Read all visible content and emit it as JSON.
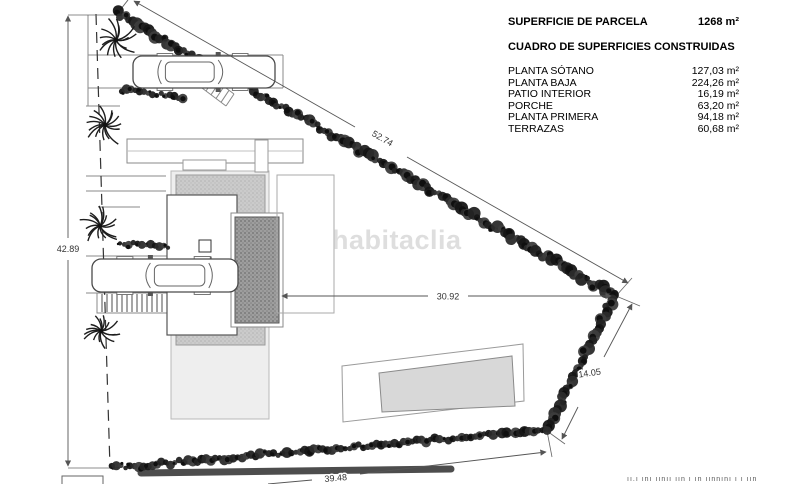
{
  "summary": {
    "parcela_label": "SUPERFICIE DE PARCELA",
    "parcela_value": "1268 m²",
    "cuadro_title": "CUADRO DE SUPERFICIES CONSTRUIDAS",
    "rows": [
      {
        "label": "PLANTA SÓTANO",
        "value": "127,03 m²"
      },
      {
        "label": "PLANTA BAJA",
        "value": "224,26 m²"
      },
      {
        "label": "PATIO INTERIOR",
        "value": "16,19 m²"
      },
      {
        "label": "PORCHE",
        "value": "63,20 m²"
      },
      {
        "label": "PLANTA PRIMERA",
        "value": "94,18 m²"
      },
      {
        "label": "TERRAZAS",
        "value": "60,68 m²"
      }
    ]
  },
  "watermark": "habitaclia",
  "footer_caption": "ıı.ı ını ıınıı ıın ı ın ıınnını ı ı ıın",
  "plan": {
    "dimensions": {
      "left": "42.89",
      "top": "52.74",
      "middle": "30.92",
      "right": "14.05",
      "bottom": "39.48"
    },
    "hedges": [
      {
        "x1": 117,
        "y1": 13,
        "x2": 614,
        "y2": 295,
        "r": 6
      },
      {
        "x1": 614,
        "y1": 295,
        "x2": 547,
        "y2": 430,
        "r": 6
      },
      {
        "x1": 112,
        "y1": 468,
        "x2": 547,
        "y2": 430,
        "r": 5
      },
      {
        "x1": 122,
        "y1": 90,
        "x2": 183,
        "y2": 97,
        "r": 4.5
      },
      {
        "x1": 120,
        "y1": 243,
        "x2": 168,
        "y2": 248,
        "r": 4.5
      }
    ],
    "palms": [
      {
        "x": 116,
        "y": 40,
        "r": 20
      },
      {
        "x": 105,
        "y": 125,
        "r": 22
      },
      {
        "x": 100,
        "y": 226,
        "r": 19
      },
      {
        "x": 101,
        "y": 331,
        "r": 17
      }
    ],
    "cars": [
      {
        "x": 133,
        "y": 56,
        "w": 142,
        "h": 32,
        "dir": 1
      },
      {
        "x": 92,
        "y": 259,
        "w": 146,
        "h": 33,
        "dir": -1
      }
    ],
    "stripes": {
      "x": 97,
      "y": 293,
      "w": 70,
      "h": 20,
      "step": 5
    },
    "ramp": {
      "x1a": 194,
      "y1a": 64,
      "x2a": 234,
      "y2a": 94,
      "x1b": 186,
      "y1b": 76,
      "x2b": 226,
      "y2b": 106,
      "rungs": 8
    }
  }
}
